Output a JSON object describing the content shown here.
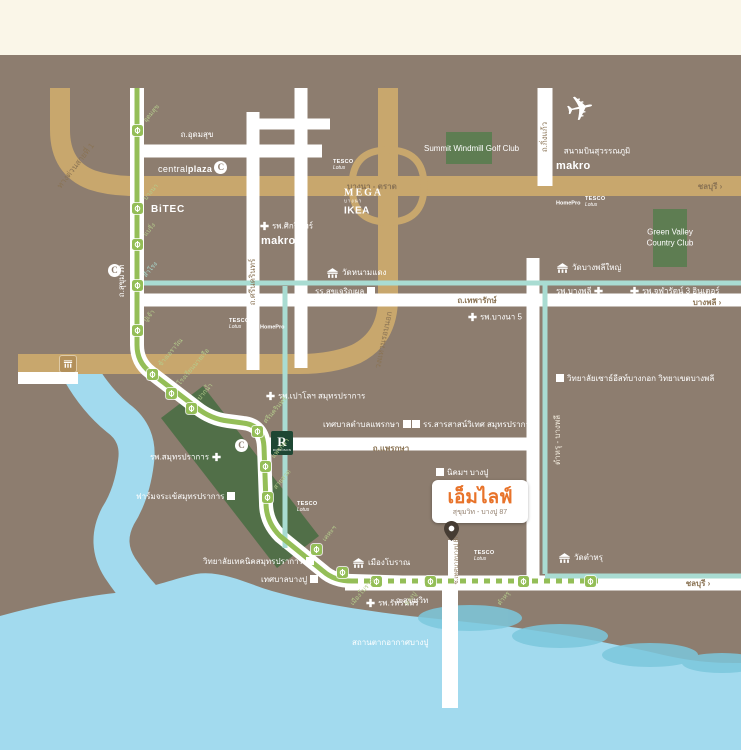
{
  "colors": {
    "cream": "#FAF6E8",
    "map": "#8D7D6F",
    "road": "#FFFFFF",
    "tan": "#C8A76D",
    "roadtext": "#8A7354",
    "rail": "#94BE57",
    "raillabel": "#B5CC8C",
    "canal": "#A9DCD2",
    "sea": "#A2DAEE",
    "wave": "#7CC8DD",
    "green1": "#5E7D52",
    "band": "#516F48",
    "robinson": "#1E4733",
    "accent": "#E8732A",
    "logotext": "#93806F",
    "pin": "#463C33",
    "toll": "#B3905A"
  },
  "logo": {
    "name": "เอ็มไลฟ์",
    "subtitle": "สุขุมวิท - บางปู 87"
  },
  "airport": {
    "label": "สนามบินสุวรรณภูมิ"
  },
  "areas": [
    {
      "id": "summit-windmill-golf-area",
      "lines": [],
      "cx": 469,
      "cy": 148
    },
    {
      "id": "green-valley-area",
      "lines": [
        "Green Valley",
        "Country Club"
      ],
      "cx": 670,
      "cy": 232
    }
  ],
  "road_labels": [
    {
      "id": "udomsuk-road-label",
      "text": "ถ.อุดมสุข",
      "x": 197,
      "y": 135,
      "rot": 0,
      "color": "white"
    },
    {
      "id": "bangna-trat-road-label",
      "text": "บางนา - ตราด",
      "x": 372,
      "y": 187,
      "rot": 0,
      "color": "road",
      "bold": true
    },
    {
      "id": "chonburi-sign-expressway",
      "text": "ชลบุรี ›",
      "x": 710,
      "y": 187,
      "rot": 0,
      "color": "road",
      "bold": true
    },
    {
      "id": "thepharak-road-label",
      "text": "ถ.เทพารักษ์",
      "x": 477,
      "y": 301,
      "rot": 0,
      "color": "road",
      "bold": true
    },
    {
      "id": "bangphli-sign",
      "text": "บางพลี ›",
      "x": 707,
      "y": 303,
      "rot": 0,
      "color": "road",
      "bold": true
    },
    {
      "id": "phraksa-road-label",
      "text": "ถ.แพรกษา",
      "x": 391,
      "y": 449,
      "rot": 0,
      "color": "road",
      "bold": true
    },
    {
      "id": "sukhumvit-road-label-bottom",
      "text": "ถ.สุขุมวิท",
      "x": 412,
      "y": 601,
      "rot": 0,
      "color": "white"
    },
    {
      "id": "chonburi-sign-sukhumvit",
      "text": "ชลบุรี ›",
      "x": 698,
      "y": 584,
      "rot": 0,
      "color": "road",
      "bold": true
    },
    {
      "id": "sukhumvit-road-label-vertical",
      "text": "ถ.สุขุมวิท",
      "x": 122,
      "y": 281,
      "rot": -90,
      "color": "white"
    },
    {
      "id": "srinakarin-road-label",
      "text": "ถ.ศรีนครินทร์",
      "x": 253,
      "y": 282,
      "rot": -90,
      "color": "road"
    },
    {
      "id": "kingkaew-road-label",
      "text": "ถ.กิ่งแก้ว",
      "x": 545,
      "y": 137,
      "rot": -90,
      "color": "road"
    },
    {
      "id": "tamru-bangphli-road-label",
      "text": "ตำหรุ - บางพลี",
      "x": 558,
      "y": 440,
      "rot": -90,
      "color": "cream"
    },
    {
      "id": "expressway-1-label",
      "text": "ทางด่วนสายที่ 1",
      "x": 76,
      "y": 166,
      "rot": -52,
      "color": "road"
    },
    {
      "id": "outer-ring-road-label",
      "text": "วงแหวนรอบนอก",
      "x": 384,
      "y": 340,
      "rot": -78,
      "color": "road"
    },
    {
      "id": "soi-bangpu-87-label",
      "text": "ซ.เทศบาลบางปู 87",
      "x": 457,
      "y": 560,
      "rot": -90,
      "color": "road",
      "size": 6
    }
  ],
  "pois": [
    {
      "id": "sikarin-hospital",
      "text": "รพ.ศิกรินทร์",
      "icon": "cross",
      "side": "left",
      "x": 260,
      "y": 226
    },
    {
      "id": "bangna5-hospital",
      "text": "รพ.บางนา 5",
      "icon": "cross",
      "side": "left",
      "x": 468,
      "y": 317
    },
    {
      "id": "bangphli-hospital",
      "text": "รพ.บางพลี",
      "icon": "cross",
      "side": "right",
      "x": 556,
      "y": 291
    },
    {
      "id": "chularat3-inter-hospital",
      "text": "รพ.จุฬารัตน์ 3 อินเตอร์",
      "icon": "cross",
      "side": "left",
      "x": 630,
      "y": 291
    },
    {
      "id": "paolo-samutprakan-hospital",
      "text": "รพ.เปาโลฯ สมุทรปราการ",
      "icon": "cross",
      "side": "left",
      "x": 266,
      "y": 396
    },
    {
      "id": "samutprakan-hospital",
      "text": "รพ.สมุทรปราการ",
      "icon": "cross",
      "side": "right",
      "x": 150,
      "y": 457
    },
    {
      "id": "ruttarin-hospital",
      "text": "รพ.รัทรินทร์",
      "icon": "cross",
      "side": "left",
      "x": 366,
      "y": 603
    },
    {
      "id": "sukjaroenphol-school",
      "text": "รร.สุขเจริญผล",
      "icon": "square",
      "side": "right",
      "x": 315,
      "y": 292
    },
    {
      "id": "phraksa-municipality",
      "text": "เทศบาลตำบลแพรกษา",
      "icon": "square",
      "side": "right",
      "x": 323,
      "y": 425
    },
    {
      "id": "sarasas-witaed-school",
      "text": "รร.สารสาสน์วิเทศ สมุทรปราการ",
      "icon": "square",
      "side": "left",
      "x": 412,
      "y": 425
    },
    {
      "id": "bangpu-industrial-estate",
      "text": "นิคมฯ บางปู",
      "icon": "square",
      "side": "left",
      "x": 436,
      "y": 473
    },
    {
      "id": "southeast-bangkok-college",
      "text": "วิทยาลัยเซาธ์อีสท์บางกอก วิทยาเขตบางพลี",
      "icon": "square",
      "side": "left",
      "x": 556,
      "y": 379
    },
    {
      "id": "crocodile-farm",
      "text": "ฟาร์มจระเข้สมุทรปราการ",
      "icon": "square",
      "side": "right",
      "x": 136,
      "y": 497
    },
    {
      "id": "samutprakan-technical-college",
      "text": "วิทยาลัยเทคนิคสมุทรปราการ",
      "icon": "square",
      "side": "right",
      "x": 203,
      "y": 562
    },
    {
      "id": "bangpu-municipality",
      "text": "เทศบาลบางปู",
      "icon": "square",
      "side": "right",
      "x": 261,
      "y": 580
    },
    {
      "id": "wat-namdaeng",
      "text": "วัดหนามแดง",
      "icon": "temple",
      "side": "left",
      "x": 326,
      "y": 273
    },
    {
      "id": "wat-bangphli-yai",
      "text": "วัดบางพลีใหญ่",
      "icon": "temple",
      "side": "left",
      "x": 556,
      "y": 268
    },
    {
      "id": "wat-tamru",
      "text": "วัดตำหรุ",
      "icon": "temple",
      "side": "left",
      "x": 558,
      "y": 558
    },
    {
      "id": "mueang-boran",
      "text": "เมืองโบราณ",
      "icon": "temple",
      "side": "left",
      "x": 352,
      "y": 563
    },
    {
      "id": "bangpu-recreation-center",
      "text": "สถานตากอากาศบางปู",
      "icon": "none",
      "side": "left",
      "x": 352,
      "y": 643
    },
    {
      "id": "summit-windmill-golf-club",
      "text": "Summit Windmill Golf Club",
      "icon": "none",
      "side": "left",
      "x": 424,
      "y": 149
    }
  ],
  "brands": [
    {
      "id": "central-plaza-bangna",
      "type": "centralplaza",
      "x": 158,
      "y": 168,
      "lines": [
        "central",
        "plaza",
        "C"
      ]
    },
    {
      "id": "bitec",
      "type": "bitec",
      "x": 151,
      "y": 208,
      "lines": [
        "BiTEC"
      ]
    },
    {
      "id": "makro-srinagarindra",
      "type": "makro",
      "x": 261,
      "y": 240,
      "lines": [
        "makro"
      ]
    },
    {
      "id": "central-samrong",
      "type": "central-disc",
      "x": 106,
      "y": 271,
      "lines": [
        "C"
      ]
    },
    {
      "id": "mega-bangna",
      "type": "mega",
      "x": 344,
      "y": 202,
      "lines": [
        "MEGA",
        "บางนา",
        "IKEA"
      ]
    },
    {
      "id": "tesco-bangna",
      "type": "tesco",
      "x": 333,
      "y": 165,
      "lines": [
        "TESCO",
        "Lotus"
      ]
    },
    {
      "id": "makro-kingkaew",
      "type": "makro",
      "x": 556,
      "y": 165,
      "lines": [
        "makro"
      ]
    },
    {
      "id": "homepro-bangphli",
      "type": "homepro",
      "x": 556,
      "y": 204,
      "lines": [
        "HomePro"
      ]
    },
    {
      "id": "tesco-bangphli",
      "type": "tesco",
      "x": 585,
      "y": 202,
      "lines": [
        "TESCO",
        "Lotus"
      ]
    },
    {
      "id": "tesco-srinakarin",
      "type": "tesco",
      "x": 229,
      "y": 324,
      "lines": [
        "TESCO",
        "Lotus"
      ]
    },
    {
      "id": "homepro-srinakarin",
      "type": "homepro",
      "x": 260,
      "y": 328,
      "lines": [
        "HomePro"
      ]
    },
    {
      "id": "tesco-sailuat",
      "type": "tesco",
      "x": 297,
      "y": 507,
      "lines": [
        "TESCO",
        "Lotus"
      ]
    },
    {
      "id": "tesco-bangpu",
      "type": "tesco",
      "x": 474,
      "y": 556,
      "lines": [
        "TESCO",
        "Lotus"
      ]
    },
    {
      "id": "robinson-samutprakan",
      "type": "robinson",
      "x": 271,
      "y": 443,
      "lines": [
        "R",
        "ROBINSON"
      ]
    },
    {
      "id": "central-samutprakan",
      "type": "central-disc",
      "x": 233,
      "y": 446,
      "lines": [
        "C"
      ]
    }
  ],
  "stations": [
    {
      "x": 137,
      "y": 130,
      "label": "อุดมสุข",
      "dir": "up"
    },
    {
      "x": 137,
      "y": 208,
      "label": "บางนา",
      "dir": "up"
    },
    {
      "x": 137,
      "y": 244,
      "label": "แบริ่ง",
      "dir": "up"
    },
    {
      "x": 137,
      "y": 285,
      "label": "สำโรง",
      "dir": "up",
      "color": "#A9DCD2"
    },
    {
      "x": 137,
      "y": 330,
      "label": "ปู่เจ้า",
      "dir": "up"
    },
    {
      "x": 152,
      "y": 374,
      "label": "ช้างเอราวัณ",
      "dir": "up"
    },
    {
      "x": 171,
      "y": 393,
      "label": "โรงเรียนนายเรือ",
      "dir": "up"
    },
    {
      "x": 191,
      "y": 408,
      "label": "ปากน้ำ",
      "dir": "up"
    },
    {
      "x": 257,
      "y": 431,
      "label": "ศรีนครินทร์",
      "dir": "up"
    },
    {
      "x": 265,
      "y": 466,
      "label": "แพรกษา",
      "dir": "up"
    },
    {
      "x": 267,
      "y": 497,
      "label": "สายลวด",
      "dir": "up"
    },
    {
      "x": 316,
      "y": 549,
      "label": "เคหะฯ",
      "dir": "up"
    },
    {
      "x": 342,
      "y": 572,
      "label": null,
      "dir": "up"
    },
    {
      "x": 376,
      "y": 581,
      "label": "เมืองโบราณ",
      "dir": "down"
    },
    {
      "x": 430,
      "y": 581,
      "label": "บางปู",
      "dir": "down"
    },
    {
      "x": 523,
      "y": 581,
      "label": "ตำหรุ",
      "dir": "down"
    },
    {
      "x": 590,
      "y": 581,
      "label": null,
      "dir": "down"
    }
  ]
}
